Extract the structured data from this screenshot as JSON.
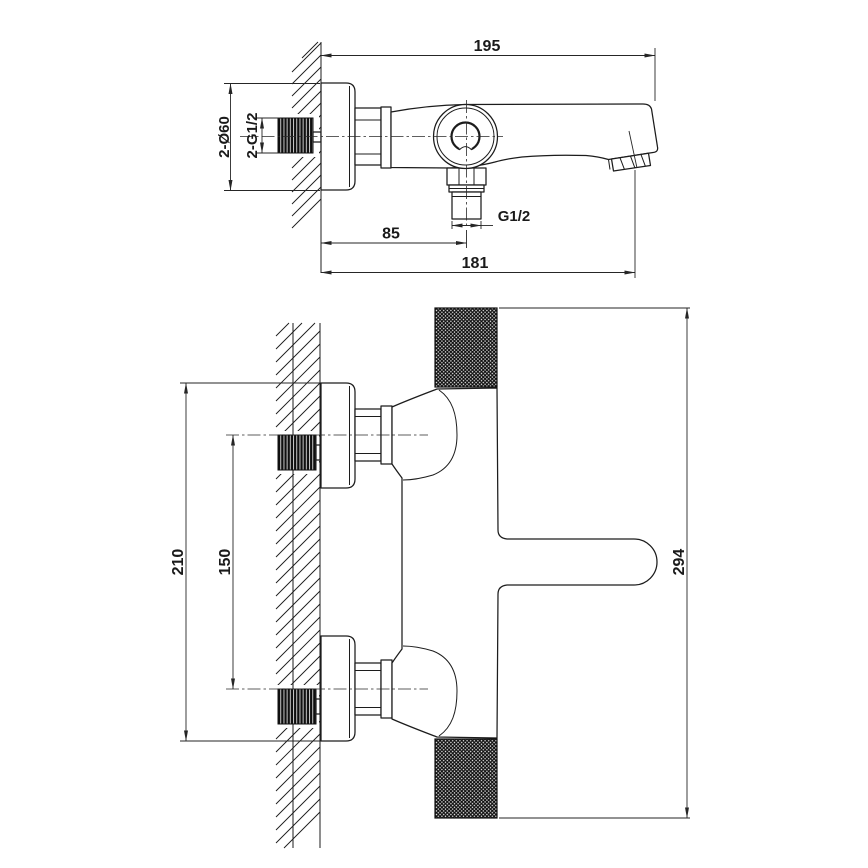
{
  "drawing": {
    "kind": "bath-mixer-installation-drawing",
    "style": {
      "line_color": "#1c1c1c",
      "background": "#ffffff",
      "text_color": "#1a1a1a"
    },
    "side_view": {
      "overall_length": "195",
      "wall_to_shower_outlet": "85",
      "wall_to_aerator": "181",
      "escutcheon_diameter": "2-Ø60",
      "inlet_thread": "2-G1/2",
      "shower_outlet_thread": "G1/2"
    },
    "plan_view": {
      "escutcheon_span": "210",
      "inlet_spacing": "150",
      "overall_width": "294"
    }
  }
}
